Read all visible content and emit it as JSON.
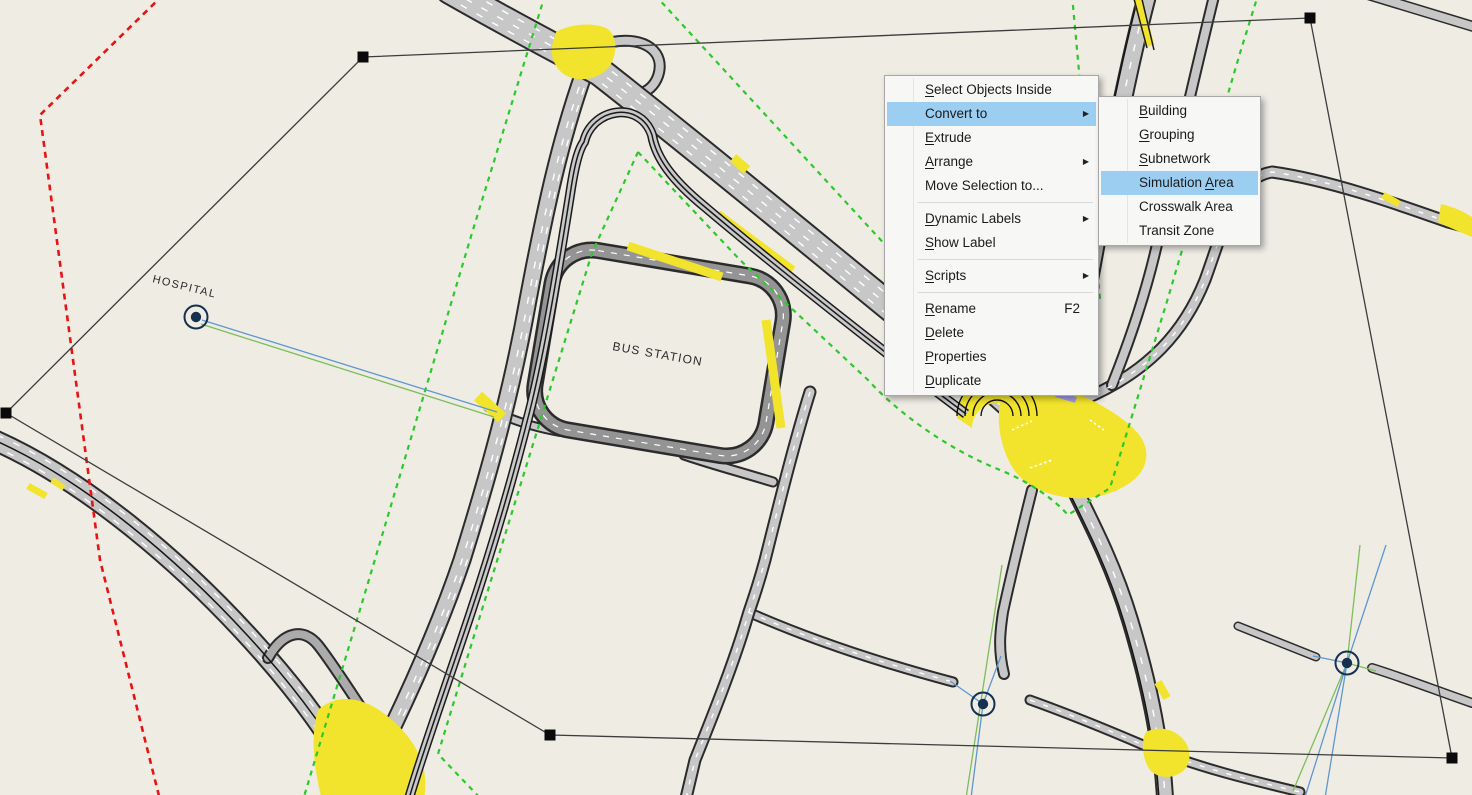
{
  "canvas": {
    "hospital_label": "HOSPITAL",
    "bus_station_label": "BUS STATION"
  },
  "colors": {
    "canvas_bg": "#EFECE4",
    "road_fill": "#C7C7C7",
    "road_casing": "#2B2B2B",
    "loop_gray": "#949494",
    "junction_yellow": "#F2E42C",
    "boundary_green": "#2CC82C",
    "boundary_red": "#E81414",
    "selection_black": "#3C3C3C",
    "menu_bg": "#F7F7F6",
    "menu_border": "#A7A7A7",
    "menu_highlight": "#9CCEF2",
    "connector_blue": "#5E97D0",
    "connector_green": "#7CBE5A",
    "node_navy": "#16314F",
    "lavender_mark": "#9C9CE8"
  },
  "context_menu": {
    "items": [
      {
        "type": "item",
        "label": "Select Objects Inside",
        "underline": 0,
        "arrow": false,
        "shortcut": "",
        "highlighted": false
      },
      {
        "type": "item",
        "label": "Convert to",
        "underline": -1,
        "arrow": true,
        "shortcut": "",
        "highlighted": true
      },
      {
        "type": "item",
        "label": "Extrude",
        "underline": 0,
        "arrow": false,
        "shortcut": "",
        "highlighted": false
      },
      {
        "type": "item",
        "label": "Arrange",
        "underline": 0,
        "arrow": true,
        "shortcut": "",
        "highlighted": false
      },
      {
        "type": "item",
        "label": "Move Selection to...",
        "underline": -1,
        "arrow": false,
        "shortcut": "",
        "highlighted": false
      },
      {
        "type": "separator"
      },
      {
        "type": "item",
        "label": "Dynamic Labels",
        "underline": 0,
        "arrow": true,
        "shortcut": "",
        "highlighted": false
      },
      {
        "type": "item",
        "label": "Show Label",
        "underline": 0,
        "arrow": false,
        "shortcut": "",
        "highlighted": false
      },
      {
        "type": "separator"
      },
      {
        "type": "item",
        "label": "Scripts",
        "underline": 0,
        "arrow": true,
        "shortcut": "",
        "highlighted": false
      },
      {
        "type": "separator"
      },
      {
        "type": "item",
        "label": "Rename",
        "underline": 0,
        "arrow": false,
        "shortcut": "F2",
        "highlighted": false
      },
      {
        "type": "item",
        "label": "Delete",
        "underline": 0,
        "arrow": false,
        "shortcut": "",
        "highlighted": false
      },
      {
        "type": "item",
        "label": "Properties",
        "underline": 0,
        "arrow": false,
        "shortcut": "",
        "highlighted": false
      },
      {
        "type": "item",
        "label": "Duplicate",
        "underline": 0,
        "arrow": false,
        "shortcut": "",
        "highlighted": false
      }
    ]
  },
  "submenu": {
    "items": [
      {
        "type": "item",
        "label": "Building",
        "underline": 0,
        "arrow": false,
        "shortcut": "",
        "highlighted": false
      },
      {
        "type": "item",
        "label": "Grouping",
        "underline": 0,
        "arrow": false,
        "shortcut": "",
        "highlighted": false
      },
      {
        "type": "item",
        "label": "Subnetwork",
        "underline": 0,
        "arrow": false,
        "shortcut": "",
        "highlighted": false
      },
      {
        "type": "item",
        "label": "Simulation Area",
        "underline": 11,
        "arrow": false,
        "shortcut": "",
        "highlighted": true
      },
      {
        "type": "item",
        "label": "Crosswalk Area",
        "underline": -1,
        "arrow": false,
        "shortcut": "",
        "highlighted": false
      },
      {
        "type": "item",
        "label": "Transit Zone",
        "underline": -1,
        "arrow": false,
        "shortcut": "",
        "highlighted": false
      }
    ]
  }
}
